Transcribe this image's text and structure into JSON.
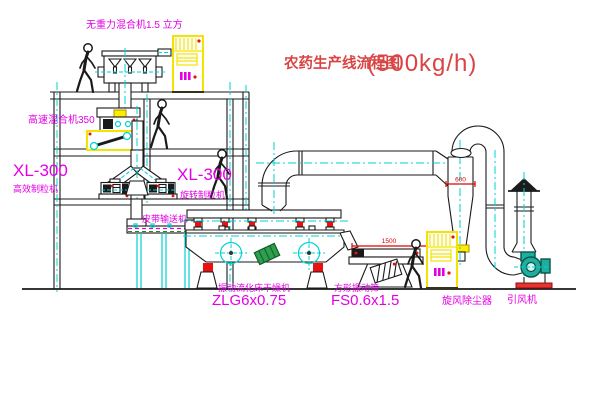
{
  "title": {
    "name": "农药生产线流程图",
    "capacity": "(500kg/h)"
  },
  "equipment": {
    "gravity_mixer": {
      "label": "无重力混合机1.5 立方"
    },
    "high_speed_mixer": {
      "label": "高速混合机350"
    },
    "granulator_left": {
      "model": "XL-300",
      "name": "高效制粒机"
    },
    "granulator_right": {
      "model": "XL-300",
      "name": "旋转制粒机"
    },
    "belt_conveyor": {
      "name": "皮带输送机"
    },
    "dryer": {
      "name": "振动流化床干燥机",
      "model": "ZLG6x0.75"
    },
    "sieve": {
      "name": "方形振动筛",
      "model": "FS0.6x1.5",
      "dim_length": "1500",
      "dim_height": "548"
    },
    "cyclone": {
      "name": "旋风除尘器",
      "dim_diameter": "600"
    },
    "fan": {
      "name": "引风机"
    }
  },
  "colors": {
    "line": "#1a1a1a",
    "centerline": "#00d2d2",
    "label_magenta": "#e400e4",
    "title_red": "#d94545",
    "dimension_red": "#e00000",
    "cabinet_yellow": "#f2e400",
    "motor_green": "#2e9e4f",
    "fan_teal": "#1fae9e",
    "background": "#ffffff"
  }
}
